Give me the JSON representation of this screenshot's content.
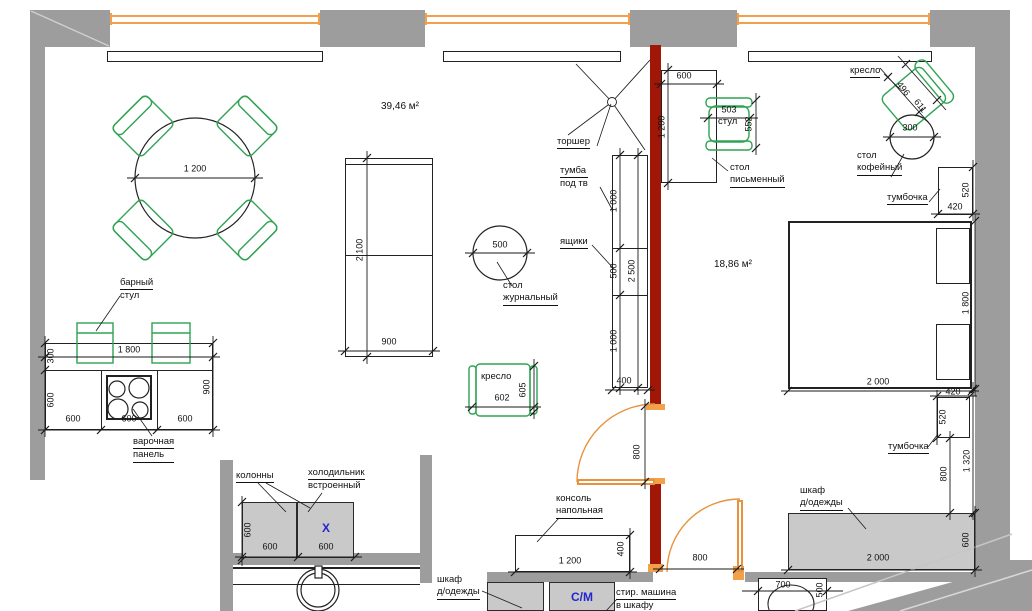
{
  "plan": {
    "title": "floor-plan",
    "areas": {
      "living": "39,46 м²",
      "bedroom": "18,86 м²"
    },
    "labels": {
      "bar_stool_1": "барный",
      "bar_stool_2": "стул",
      "cook_1": "варочная",
      "cook_2": "панель",
      "columns": "колонны",
      "fridge_1": "холодильник",
      "fridge_2": "встроенный",
      "coffee_c_1": "стол",
      "coffee_c_2": "журнальный",
      "armchair_center": "кресло",
      "floor_lamp": "торшер",
      "tv_stand_1": "тумба",
      "tv_stand_2": "под тв",
      "drawers": "ящики",
      "chair": "стул",
      "desk_1": "стол",
      "desk_2": "письменный",
      "armchair_tr": "кресло",
      "coffee_tr_1": "стол",
      "coffee_tr_2": "кофейный",
      "nightstand_top": "тумбочка",
      "nightstand_bottom": "тумбочка",
      "wardrobe_bed_1": "шкаф",
      "wardrobe_bed_2": "д/одежды",
      "console_1": "консоль",
      "console_2": "напольная",
      "wardrobe_bot_1": "шкаф",
      "wardrobe_bot_2": "д/одежды",
      "washer_1": "стир. машина",
      "washer_2": "в шкафу",
      "sm_mark": "С/М",
      "x_mark": "X"
    },
    "dims": {
      "dining": "1 200",
      "kitchen_w": "1 800",
      "kitchen_bar": "300",
      "kitchen_d": "600",
      "kitchen_h": "900",
      "kitchen_c1": "600",
      "kitchen_c2": "600",
      "kitchen_c3": "600",
      "col_h": "600",
      "col_w1": "600",
      "col_w2": "600",
      "sofa_l": "2 100",
      "sofa_w": "900",
      "jt_d": "500",
      "arm_w": "602",
      "arm_d": "605",
      "tv_s1": "1 000",
      "tv_s2": "500",
      "tv_s3": "1 000",
      "tv_total": "2 500",
      "tv_d": "400",
      "desk_w": "600",
      "desk_l": "1 200",
      "chair_w": "503",
      "chair_d": "552",
      "armtr_w": "496",
      "armtr_d": "611",
      "coffee_d": "300",
      "nst_w": "420",
      "nst_d": "520",
      "bed_w": "1 800",
      "bed_l": "2 000",
      "nsb_w": "420",
      "nsb_d": "520",
      "gap_800": "800",
      "gap_1320": "1 320",
      "ward_l": "2 000",
      "ward_d": "600",
      "cons_l": "1 200",
      "cons_d": "400",
      "door1": "800",
      "door2": "800",
      "wc_w": "700",
      "wc_d": "500"
    },
    "colors": {
      "wall": "#9d9d9d",
      "bearing_wall": "#a01708",
      "window": "#f2a04a",
      "furniture": "#2fa352",
      "mark": "#2525cc"
    }
  }
}
